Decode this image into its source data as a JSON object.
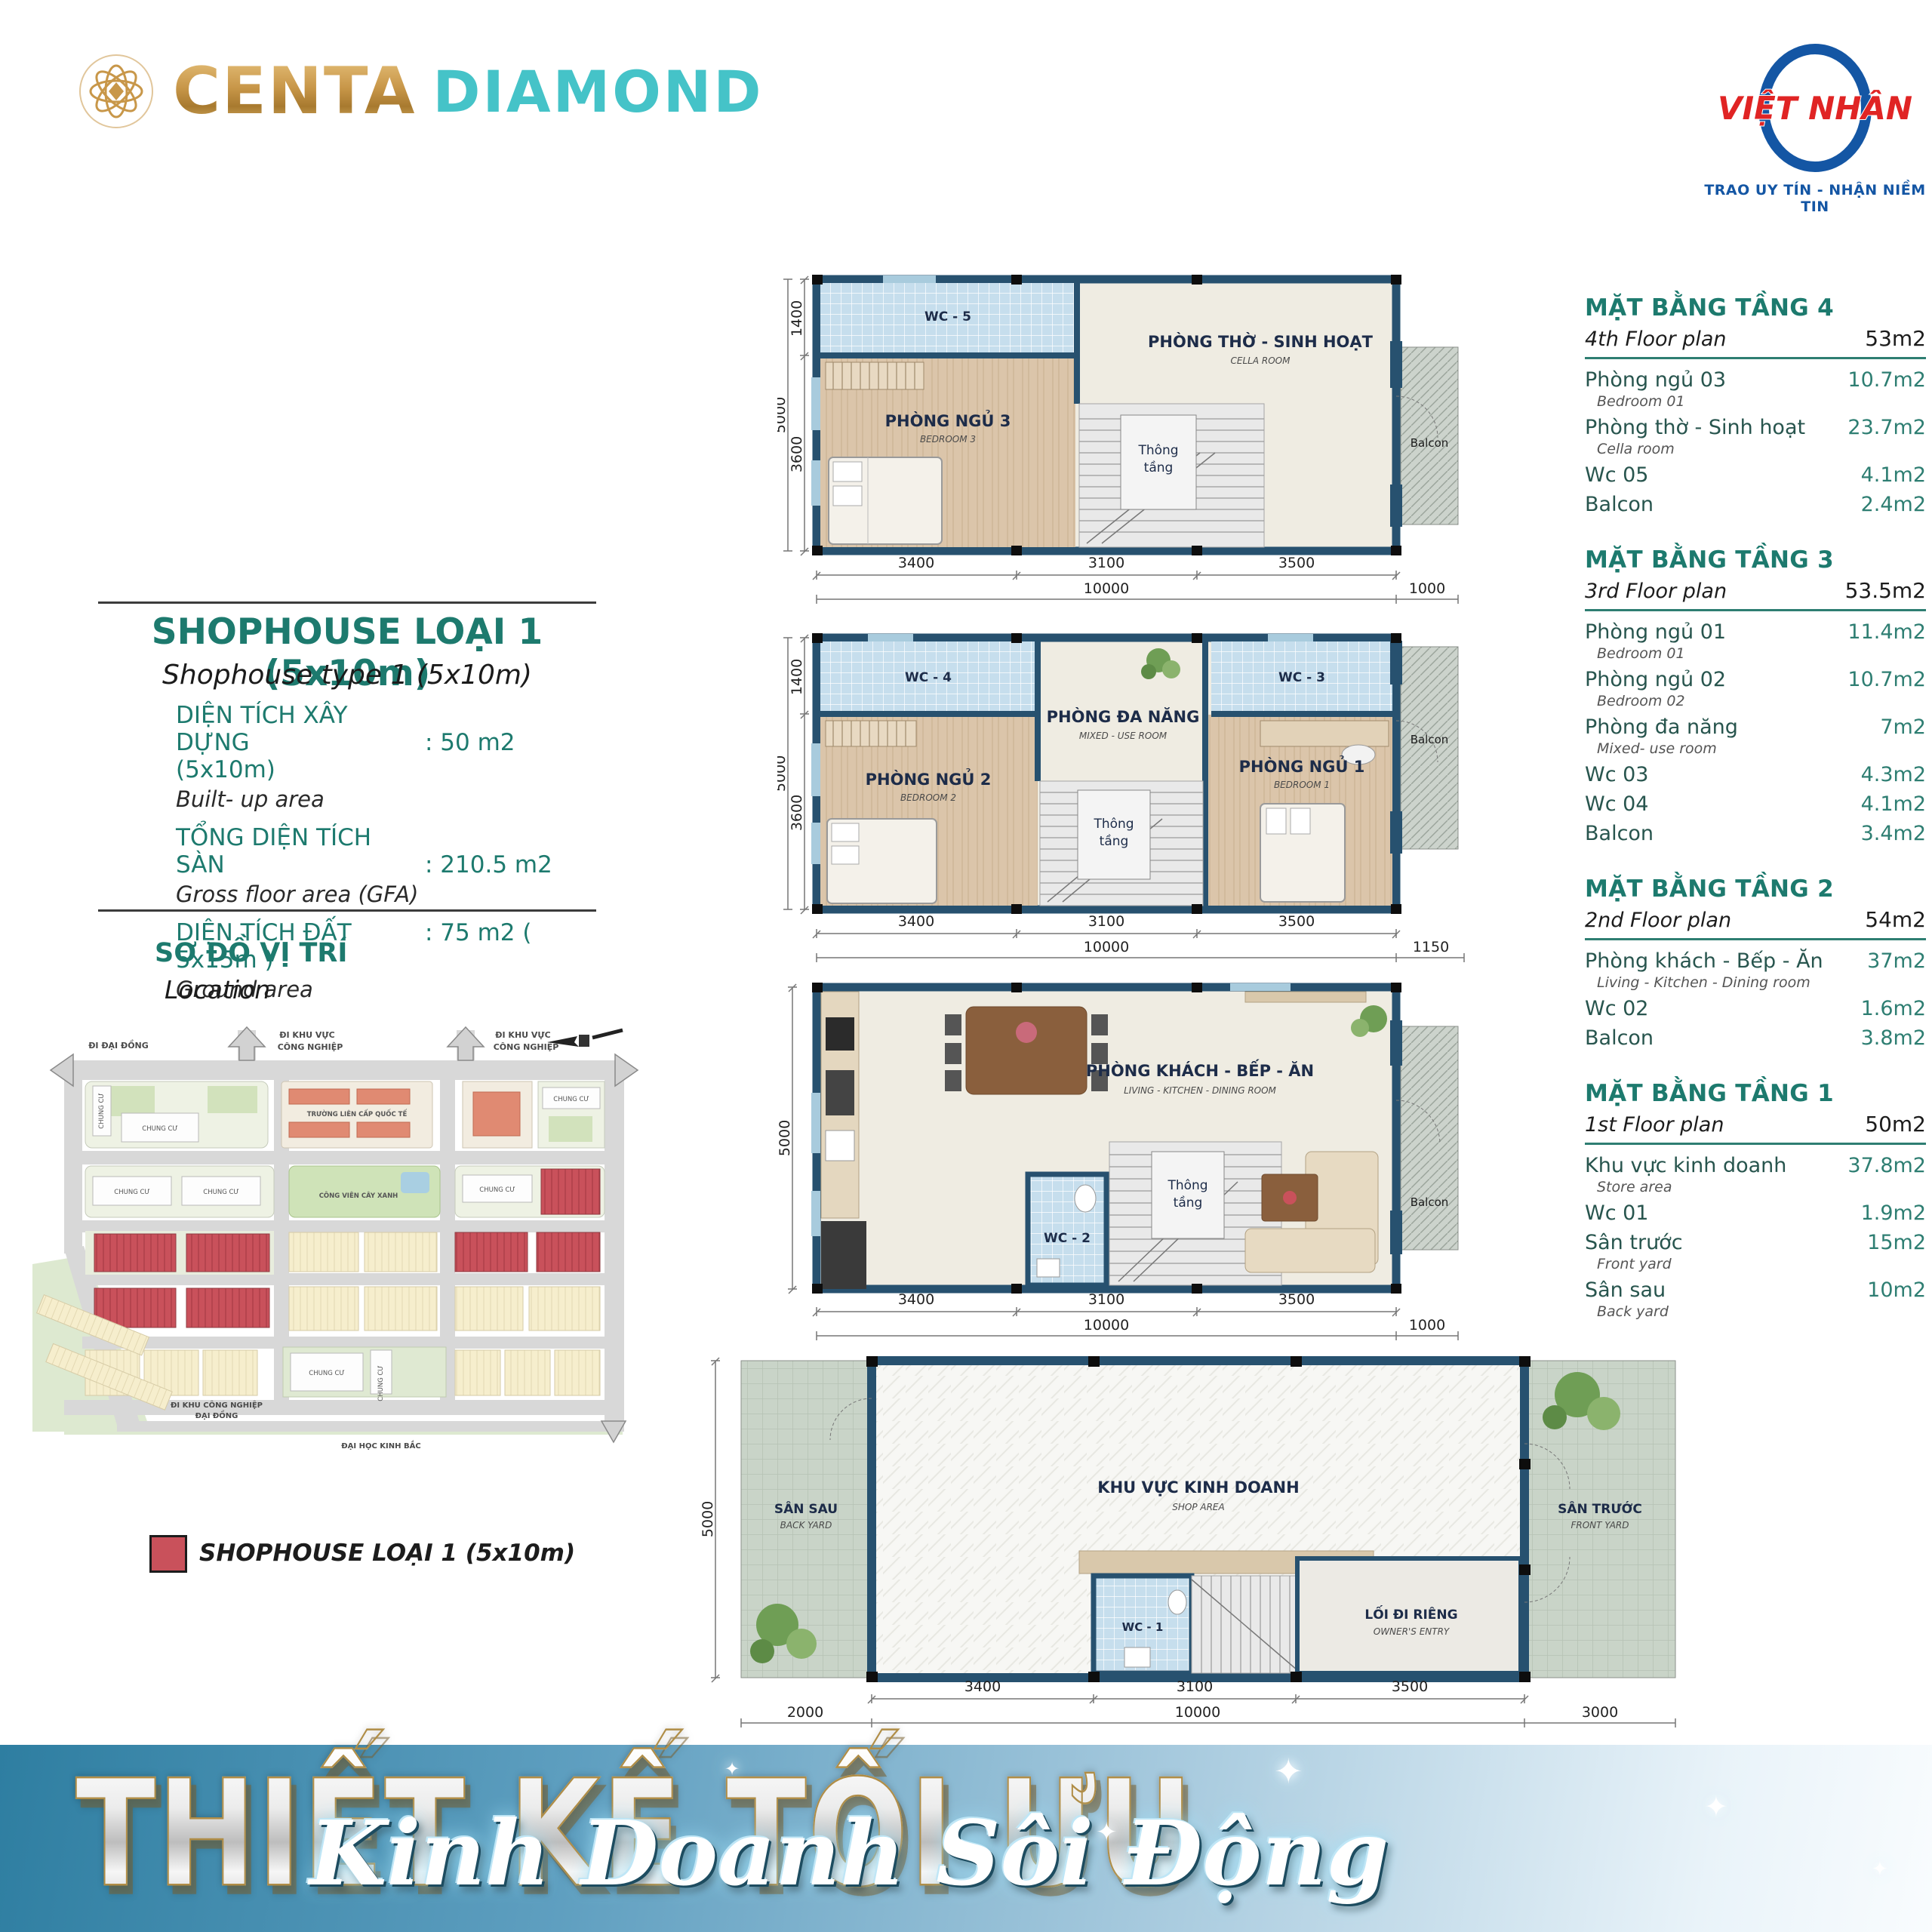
{
  "header": {
    "brand": {
      "name": "CENTA",
      "suffix": "DIAMOND"
    },
    "partner": {
      "name": "VIỆT NHÂN",
      "tagline": "TRAO UY TÍN - NHẬN NIỀM TIN"
    }
  },
  "info": {
    "title": "SHOPHOUSE LOẠI 1 (5x10m)",
    "subtitle": "Shophouse type 1 (5x10m)",
    "specs": [
      {
        "label": "DIỆN TÍCH XÂY DỰNG",
        "value": ": 50 m2 (5x10m)",
        "sub": "Built- up area"
      },
      {
        "label": "TỔNG DIỆN TÍCH SÀN",
        "value": ": 210.5 m2",
        "sub": "Gross floor area (GFA)"
      },
      {
        "label": "DIỆN TÍCH ĐẤT",
        "value": ": 75 m2 ( 5x15m )",
        "sub": "Ground area"
      }
    ]
  },
  "location": {
    "title": "SƠ ĐỒ VỊ TRÍ",
    "subtitle": "Location",
    "map": {
      "di_dai_dong": "ĐI ĐẠI ĐỒNG",
      "di_khu_vuc_1": "ĐI KHU VỰC",
      "di_khu_vuc_2": "CÔNG NGHIỆP",
      "school": "TRƯỜNG LIÊN CẤP QUỐC TẾ",
      "park": "CÔNG VIÊN CÂY XANH",
      "chung_cu": "CHUNG CƯ",
      "di_kcn_1": "ĐI KHU CÔNG NGHIỆP",
      "di_kcn_2": "ĐẠI ĐỒNG",
      "dai_hoc": "ĐẠI HỌC KINH BẮC"
    },
    "legend": {
      "label": "SHOPHOUSE LOẠI 1 (5x10m)",
      "color": "#c9515b"
    }
  },
  "plans": [
    {
      "name": "floor-4",
      "rooms": {
        "wc": "WC - 5",
        "bed": "PHÒNG NGỦ 3",
        "bed_sub": "BEDROOM 3",
        "main": "PHÒNG THỜ - SINH HOẠT",
        "main_sub": "CELLA ROOM",
        "void1": "Thông",
        "void2": "tầng",
        "balcony": "Balcon"
      },
      "dims": {
        "d1400": "1400",
        "d3600": "3600",
        "d5000": "5000",
        "b1": "3400",
        "b2": "3100",
        "b3": "3500",
        "total": "10000",
        "right": "1000"
      }
    },
    {
      "name": "floor-3",
      "rooms": {
        "wc_l": "WC - 4",
        "wc_r": "WC - 3",
        "multi": "PHÒNG ĐA NĂNG",
        "multi_sub": "MIXED - USE ROOM",
        "bed2": "PHÒNG NGỦ 2",
        "bed2_sub": "BEDROOM 2",
        "bed1": "PHÒNG NGỦ 1",
        "bed1_sub": "BEDROOM 1",
        "void1": "Thông",
        "void2": "tầng",
        "balcony": "Balcon"
      },
      "dims": {
        "d1400": "1400",
        "d3600": "3600",
        "d5000": "5000",
        "b1": "3400",
        "b2": "3100",
        "b3": "3500",
        "total": "10000",
        "right": "1150"
      }
    },
    {
      "name": "floor-2",
      "rooms": {
        "living": "PHÒNG KHÁCH - BẾP - ĂN",
        "living_sub": "LIVING - KITCHEN - DINING ROOM",
        "wc": "WC - 2",
        "void1": "Thông",
        "void2": "tầng",
        "balcony": "Balcon"
      },
      "dims": {
        "d5000": "5000",
        "b1": "3400",
        "b2": "3100",
        "b3": "3500",
        "total": "10000",
        "right": "1000"
      }
    },
    {
      "name": "floor-1",
      "rooms": {
        "back": "SÂN SAU",
        "back_sub": "BACK YARD",
        "shop": "KHU VỰC KINH DOANH",
        "shop_sub": "SHOP AREA",
        "wc": "WC - 1",
        "entry": "LỐI ĐI RIÊNG",
        "entry_sub": "OWNER'S ENTRY",
        "front": "SÂN TRƯỚC",
        "front_sub": "FRONT YARD"
      },
      "dims": {
        "d5000": "5000",
        "left": "2000",
        "b1": "3400",
        "b2": "3100",
        "b3": "3500",
        "total": "10000",
        "right": "3000"
      }
    }
  ],
  "tables": [
    {
      "title": "MẶT BẰNG TẦNG 4",
      "subtitle": "4th Floor plan",
      "total": "53m2",
      "rows": [
        {
          "name": "Phòng ngủ 03",
          "sub": "Bedroom 01",
          "value": "10.7m2"
        },
        {
          "name": "Phòng thờ - Sinh hoạt",
          "sub": "Cella room",
          "value": "23.7m2"
        },
        {
          "name": "Wc 05",
          "value": "4.1m2"
        },
        {
          "name": "Balcon",
          "value": "2.4m2"
        }
      ]
    },
    {
      "title": "MẶT BẰNG TẦNG 3",
      "subtitle": "3rd Floor plan",
      "total": "53.5m2",
      "rows": [
        {
          "name": "Phòng ngủ 01",
          "sub": "Bedroom 01",
          "value": "11.4m2"
        },
        {
          "name": "Phòng ngủ 02",
          "sub": "Bedroom 02",
          "value": "10.7m2"
        },
        {
          "name": "Phòng đa năng",
          "sub": "Mixed- use room",
          "value": "7m2"
        },
        {
          "name": "Wc 03",
          "value": "4.3m2"
        },
        {
          "name": "Wc 04",
          "value": "4.1m2"
        },
        {
          "name": "Balcon",
          "value": "3.4m2"
        }
      ]
    },
    {
      "title": "MẶT BẰNG TẦNG 2",
      "subtitle": "2nd Floor plan",
      "total": "54m2",
      "rows": [
        {
          "name": "Phòng khách - Bếp - Ăn",
          "sub": "Living - Kitchen - Dining room",
          "value": "37m2"
        },
        {
          "name": "Wc 02",
          "value": "1.6m2"
        },
        {
          "name": "Balcon",
          "value": "3.8m2"
        }
      ]
    },
    {
      "title": "MẶT BẰNG TẦNG 1",
      "subtitle": "1st Floor plan",
      "total": "50m2",
      "rows": [
        {
          "name": "Khu vực kinh doanh",
          "sub": "Store area",
          "value": "37.8m2"
        },
        {
          "name": "Wc 01",
          "value": "1.9m2"
        },
        {
          "name": "Sân trước",
          "sub": "Front yard",
          "value": "15m2"
        },
        {
          "name": "Sân sau",
          "sub": "Back yard",
          "value": "10m2"
        }
      ]
    }
  ],
  "banner": {
    "title": "THIẾT KẾ TỐI ƯU",
    "subtitle": "Kinh Doanh Sôi Động"
  },
  "colors": {
    "teal_heading": "#1d7a6e",
    "turquoise": "#45c3c8",
    "gold": "#c89749",
    "legend_red": "#c9515b",
    "wall_blue": "#27516f",
    "partner_blue": "#1456a4",
    "partner_red": "#e02424",
    "banner_from": "#2e7ea1",
    "banner_to": "#f9fcfe"
  }
}
